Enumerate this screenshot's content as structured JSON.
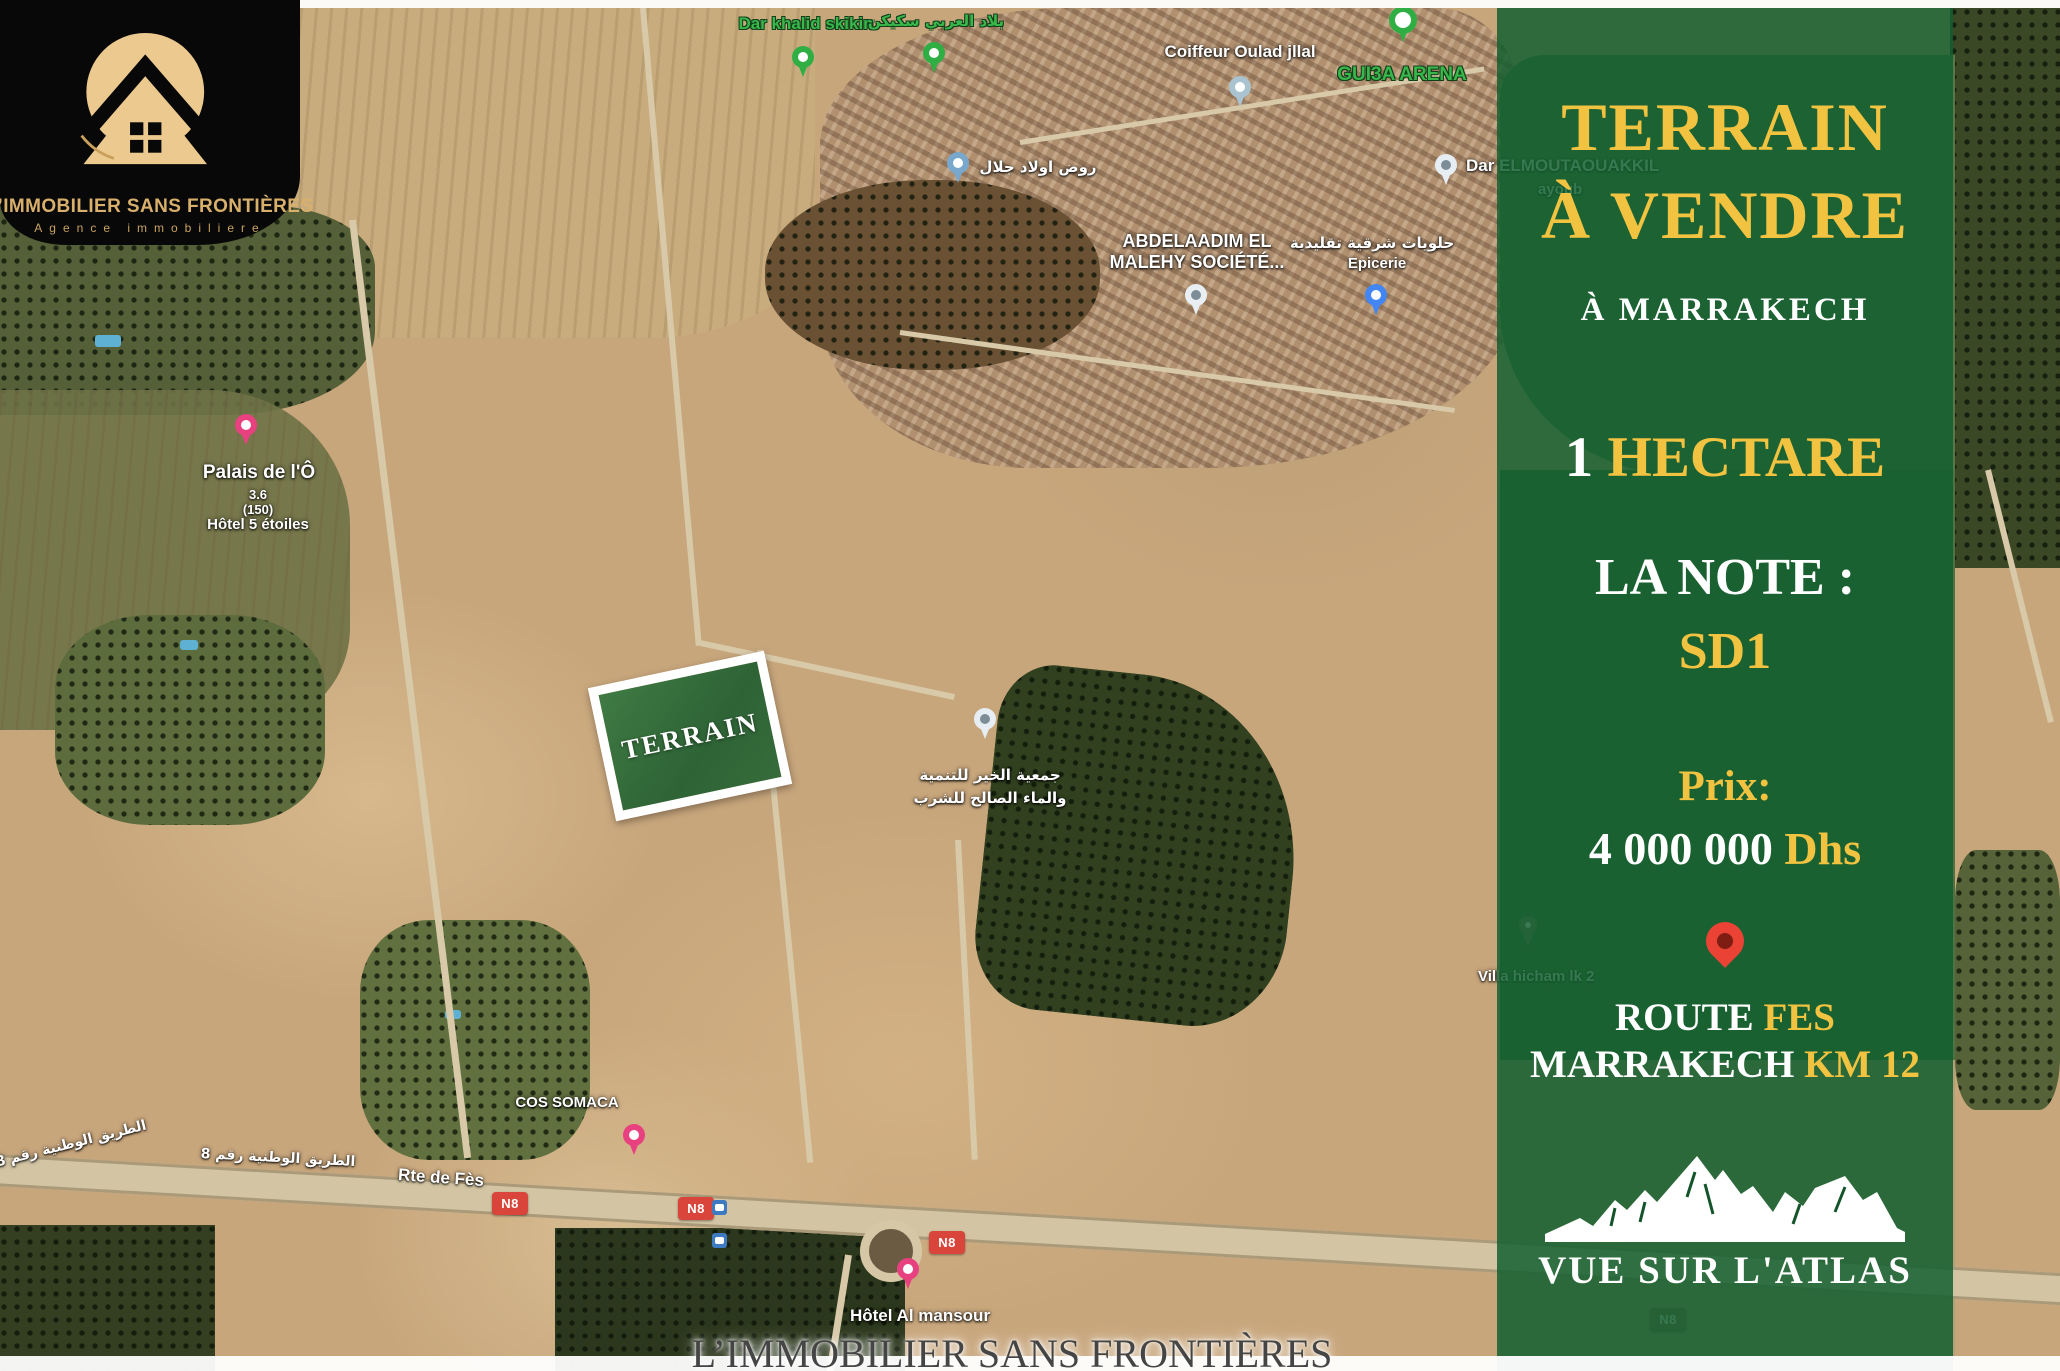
{
  "logo": {
    "title": "L’IMMOBILIER SANS FRONTIÈRES",
    "subtitle": "Agence immobiliere"
  },
  "panel": {
    "title_line1": "TERRAIN",
    "title_line2": "À VENDRE",
    "city": "À MARRAKECH",
    "area_number": "1",
    "area_word": "HECTARE",
    "note_label": "LA NOTE :",
    "note_value": "SD1",
    "price_label": "Prix:",
    "price_amount": "4 000 000",
    "price_currency": "Dhs",
    "route_word1": "ROUTE",
    "route_word2": "FES",
    "route_word3": "MARRAKECH",
    "route_word4": "KM 12",
    "view_caption": "VUE SUR L'ATLAS"
  },
  "map": {
    "terrain_tag": "TERRAIN",
    "poi": {
      "dar_khalid_skikin": "Dar khalid skikin",
      "blad_el_arabi": "بلاد العربي سكيكن",
      "coiffeur": "Coiffeur Oulad jllal",
      "guia_arena": "GUI3A ARENA",
      "dar_elmoutaouakkil": "Dar ELMOUTAOUAKKIL",
      "dar_elmoutaouakkil_2": "ayoub",
      "rawd_oulad_jlal": "روض اولاد جلال",
      "abdelaadim_line1": "ABDELAADIM EL",
      "abdelaadim_line2": "MALEHY SOCIÉTÉ...",
      "halawiyat": "حلويات شرقية تقليدية",
      "epicerie": "Epicerie",
      "palais_name": "Palais de l'Ô",
      "palais_rating": "3.6",
      "palais_reviews": "(150)",
      "palais_category": "Hôtel 5 étoiles",
      "association_line1": "جمعية الخير للتنمية",
      "association_line2": "والماء الصالح للشرب",
      "villa_hicham": "Villa hicham lk 2",
      "cos_somaca": "COS SOMACA",
      "hotel_al_mansour": "Hôtel Al mansour"
    },
    "roads": {
      "rte_de_fes": "Rte de Fès",
      "route_nationale_ar": "الطريق الوطنية رقم 8",
      "n8": "N8"
    }
  },
  "footer": {
    "agency": "L’IMMOBILIER SANS FRONTIÈRES"
  },
  "colors": {
    "gold": "#F2C340",
    "panel_green": "#115E2E",
    "label_green": "#38B74B",
    "pin_red": "#EA4335"
  }
}
